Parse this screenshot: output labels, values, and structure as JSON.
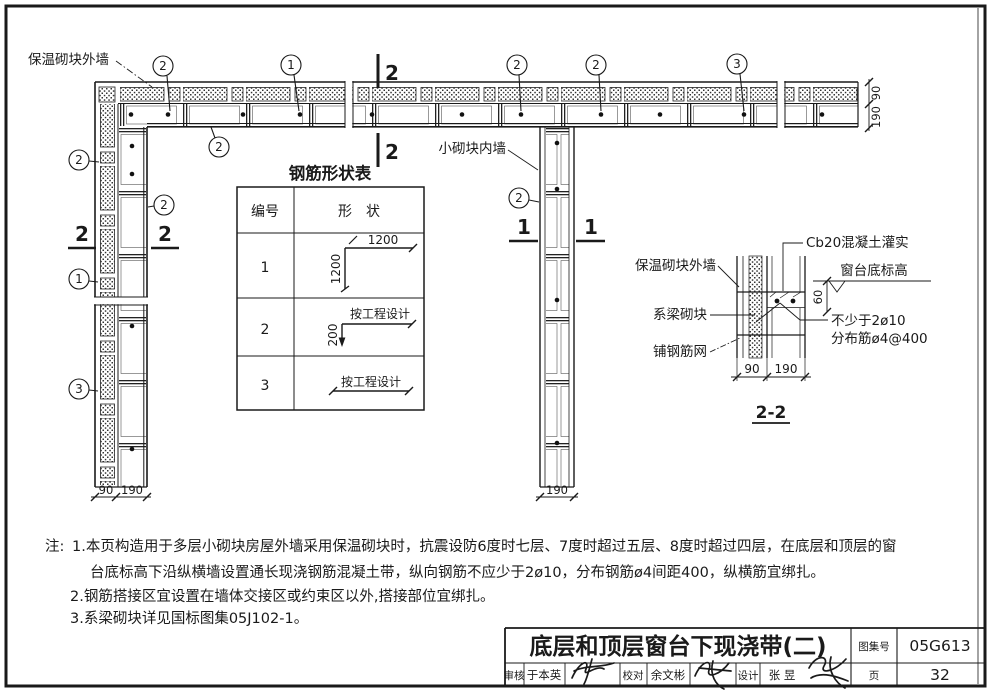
{
  "plan": {
    "exterior_wall_label": "保温砌块外墙",
    "interior_wall_label": "小砌块内墙",
    "callout_1": "1",
    "callout_2": "2",
    "callout_3": "3",
    "section_1": "1",
    "section_2": "2",
    "dim_90": "90",
    "dim_190": "190"
  },
  "rebar_table": {
    "title": "钢筋形状表",
    "col_no": "编号",
    "col_shape": "形　状",
    "rows": [
      {
        "no": "1",
        "dim_h": "1200",
        "dim_v": "1200"
      },
      {
        "no": "2",
        "dim_h": "按工程设计",
        "dim_v": "200"
      },
      {
        "no": "3",
        "dim_h": "按工程设计"
      }
    ]
  },
  "detail": {
    "title": "2-2",
    "label_cb20": "Cb20混凝土灌实",
    "label_sill": "窗台底标高",
    "label_ext_wall": "保温砌块外墙",
    "label_tie_block": "系梁砌块",
    "label_mesh": "铺钢筋网",
    "label_rebar_min": "不少于2ø10",
    "label_dist": "分布筋ø4@400",
    "dim_60": "60",
    "dim_90": "90",
    "dim_190": "190"
  },
  "notes": {
    "prefix": "注:",
    "line1": "1.本页构造用于多层小砌块房屋外墙采用保温砌块时，抗震设防6度时七层、7度时超过五层、8度时超过四层，在底层和顶层的窗",
    "line2": "台底标高下沿纵横墙设置通长现浇钢筋混凝土带，纵向钢筋不应少于2ø10，分布钢筋ø4间距400，纵横筋宜绑扎。",
    "line3": "2.钢筋搭接区宜设置在墙体交接区或约束区以外,搭接部位宜绑扎。",
    "line4": "3.系梁砌块详见国标图集05J102-1。"
  },
  "titleblock": {
    "title": "底层和顶层窗台下现浇带(二)",
    "atlas_label": "图集号",
    "atlas_no": "05G613",
    "page_label": "页",
    "page_no": "32",
    "review_label": "审核",
    "reviewer": "于本英",
    "proof_label": "校对",
    "proofer": "余文彬",
    "design_label": "设计",
    "designer": "张  昱"
  }
}
